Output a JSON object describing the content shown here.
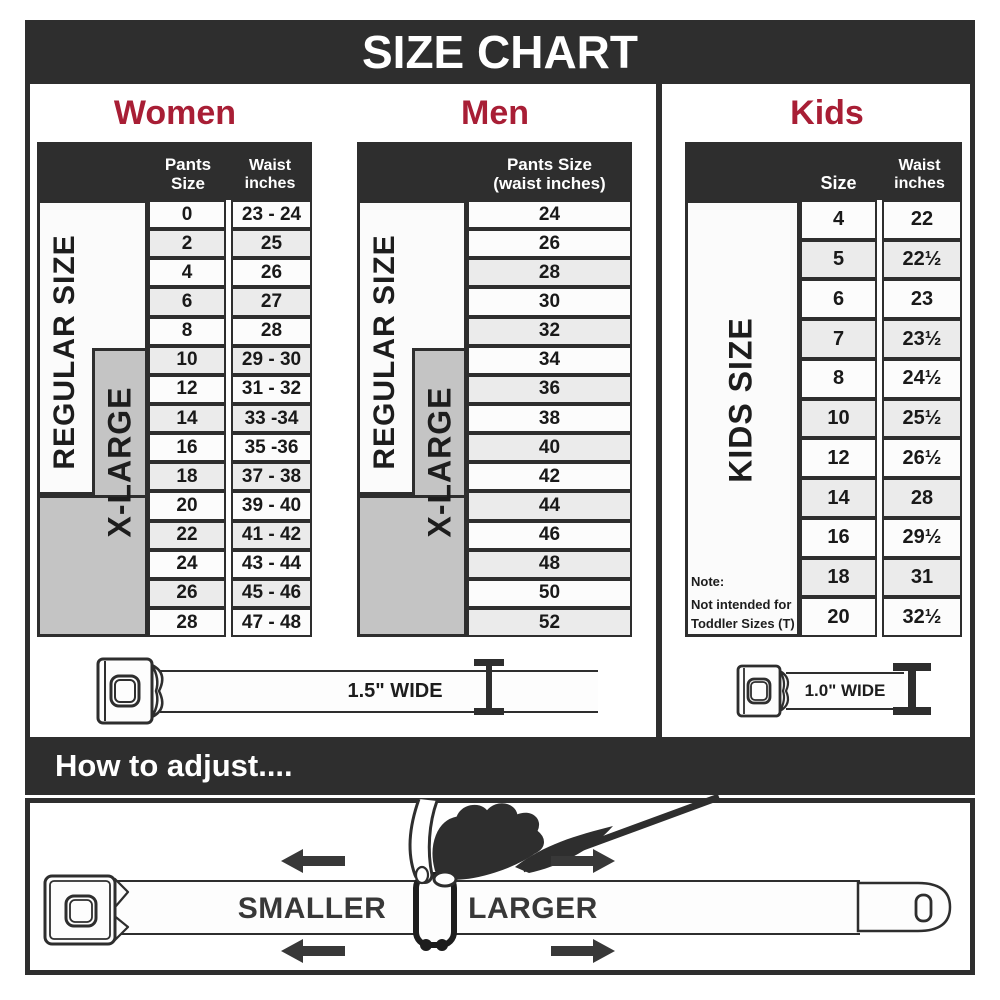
{
  "title": "SIZE CHART",
  "colors": {
    "dark": "#2e2e2e",
    "accent_red": "#a81e35",
    "xlarge_gray": "#c4c4c4",
    "row_alt": "#ebebeb"
  },
  "women": {
    "heading": "Women",
    "col1_header": "Pants Size",
    "col2_header_l1": "Waist",
    "col2_header_l2": "inches",
    "regular_label": "REGULAR SIZE",
    "xlarge_label": "X-LARGE",
    "belt_label": "1.5\" WIDE"
  },
  "men": {
    "heading": "Men",
    "col_header_l1": "Pants Size",
    "col_header_l2": "(waist inches)",
    "regular_label": "REGULAR SIZE",
    "xlarge_label": "X-LARGE"
  },
  "kids": {
    "heading": "Kids",
    "col1_header": "Size",
    "col2_header_l1": "Waist",
    "col2_header_l2": "inches",
    "side_label": "KIDS SIZE",
    "note_lines": [
      "Note:",
      "Not intended for",
      "Toddler Sizes (T)"
    ],
    "belt_label": "1.0\" WIDE"
  },
  "adjust": {
    "heading": "How to adjust....",
    "smaller": "SMALLER",
    "larger": "LARGER"
  },
  "chart_data": [
    {
      "type": "table",
      "title": "Women",
      "columns": [
        "Pants Size",
        "Waist inches"
      ],
      "rows": [
        [
          "0",
          "23 - 24"
        ],
        [
          "2",
          "25"
        ],
        [
          "4",
          "26"
        ],
        [
          "6",
          "27"
        ],
        [
          "8",
          "28"
        ],
        [
          "10",
          "29 - 30"
        ],
        [
          "12",
          "31 - 32"
        ],
        [
          "14",
          "33 -34"
        ],
        [
          "16",
          "35 -36"
        ],
        [
          "18",
          "37 - 38"
        ],
        [
          "20",
          "39 - 40"
        ],
        [
          "22",
          "41 - 42"
        ],
        [
          "24",
          "43 - 44"
        ],
        [
          "26",
          "45 - 46"
        ],
        [
          "28",
          "47 - 48"
        ]
      ]
    },
    {
      "type": "table",
      "title": "Men",
      "columns": [
        "Pants Size (waist inches)"
      ],
      "rows": [
        "24",
        "26",
        "28",
        "30",
        "32",
        "34",
        "36",
        "38",
        "40",
        "42",
        "44",
        "46",
        "48",
        "50",
        "52"
      ]
    },
    {
      "type": "table",
      "title": "Kids",
      "columns": [
        "Size",
        "Waist inches"
      ],
      "rows": [
        [
          "4",
          "22"
        ],
        [
          "5",
          "22½"
        ],
        [
          "6",
          "23"
        ],
        [
          "7",
          "23½"
        ],
        [
          "8",
          "24½"
        ],
        [
          "10",
          "25½"
        ],
        [
          "12",
          "26½"
        ],
        [
          "14",
          "28"
        ],
        [
          "16",
          "29½"
        ],
        [
          "18",
          "31"
        ],
        [
          "20",
          "32½"
        ]
      ]
    }
  ]
}
